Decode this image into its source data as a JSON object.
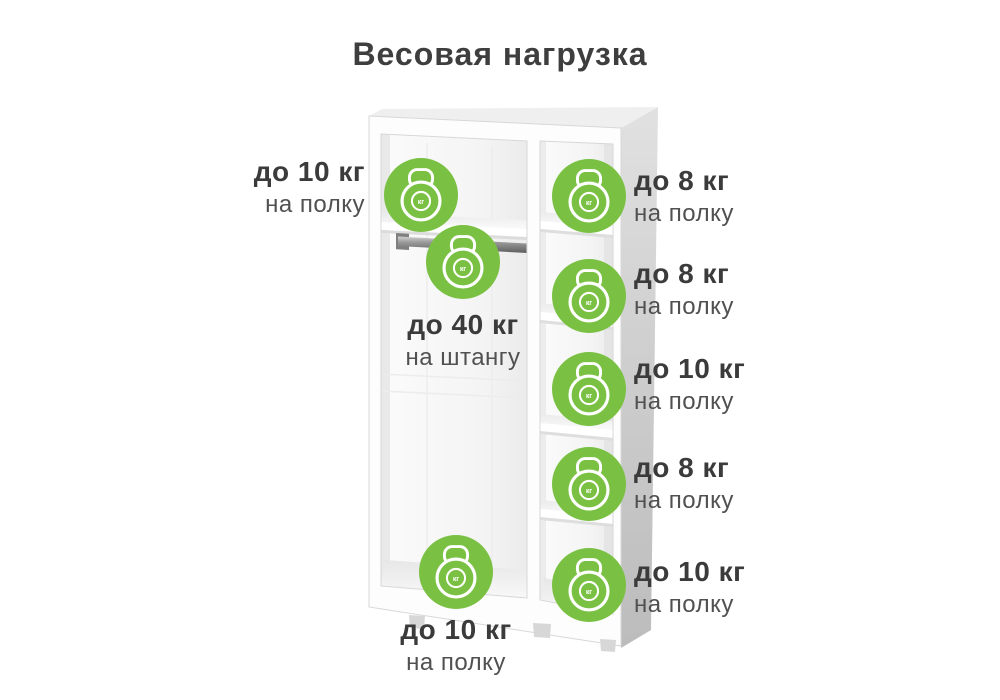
{
  "title": "Весовая нагрузка",
  "colors": {
    "badge_green": "#7AC143",
    "icon_stroke": "#FFFFFF",
    "heading_text": "#3E3E3E",
    "limit_text": "#3B3B3B",
    "target_text": "#515151",
    "cabinet_side_gray": "#C9C9C9"
  },
  "icon": {
    "name": "kettlebell-icon",
    "unit": "кг"
  },
  "labels": {
    "left_shelf": {
      "limit": "до 10 кг",
      "target": "на полку"
    },
    "rod": {
      "limit": "до 40 кг",
      "target": "на штангу"
    },
    "bottom_shelf": {
      "limit": "до 10 кг",
      "target": "на полку"
    },
    "right_shelf_1": {
      "limit": "до 8 кг",
      "target": "на полку"
    },
    "right_shelf_2": {
      "limit": "до 8 кг",
      "target": "на полку"
    },
    "right_shelf_3": {
      "limit": "до 10 кг",
      "target": "на полку"
    },
    "right_shelf_4": {
      "limit": "до 8 кг",
      "target": "на полку"
    },
    "right_shelf_5": {
      "limit": "до 10 кг",
      "target": "на полку"
    }
  }
}
